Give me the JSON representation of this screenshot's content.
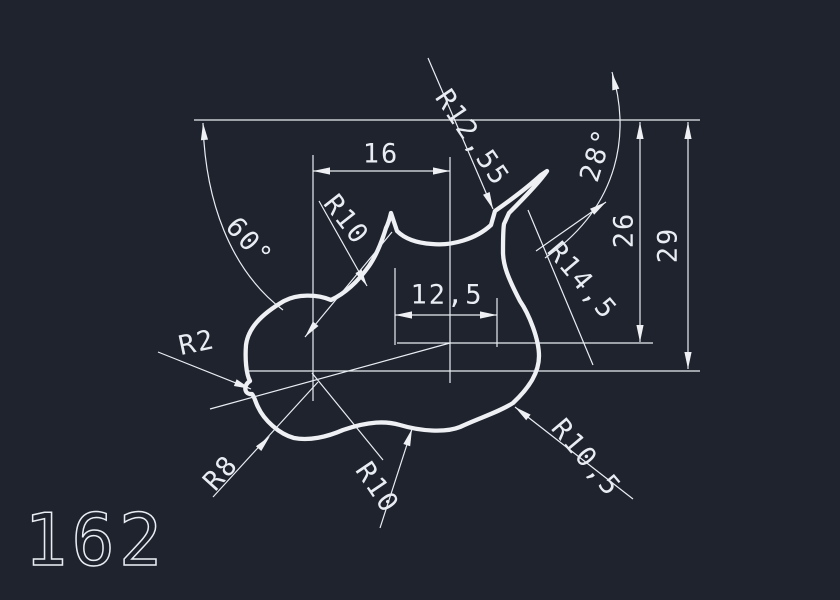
{
  "app": {
    "type": "cad-drawing-viewport"
  },
  "canvas": {
    "background_color": "#1e232d",
    "line_color": "#e9edf3"
  },
  "part_number": {
    "value": "162"
  },
  "labels": {
    "width_16": "16",
    "width_12_5": "12,5",
    "height_26": "26",
    "height_29": "29",
    "angle_60": "60°",
    "angle_28": "28°",
    "radius_r10_top": "R10",
    "radius_r12_55": "R12,55",
    "radius_r14_5": "R14,5",
    "radius_r2": "R2",
    "radius_r8": "R8",
    "radius_r10_bottom": "R10",
    "radius_r10_5": "R10,5"
  }
}
